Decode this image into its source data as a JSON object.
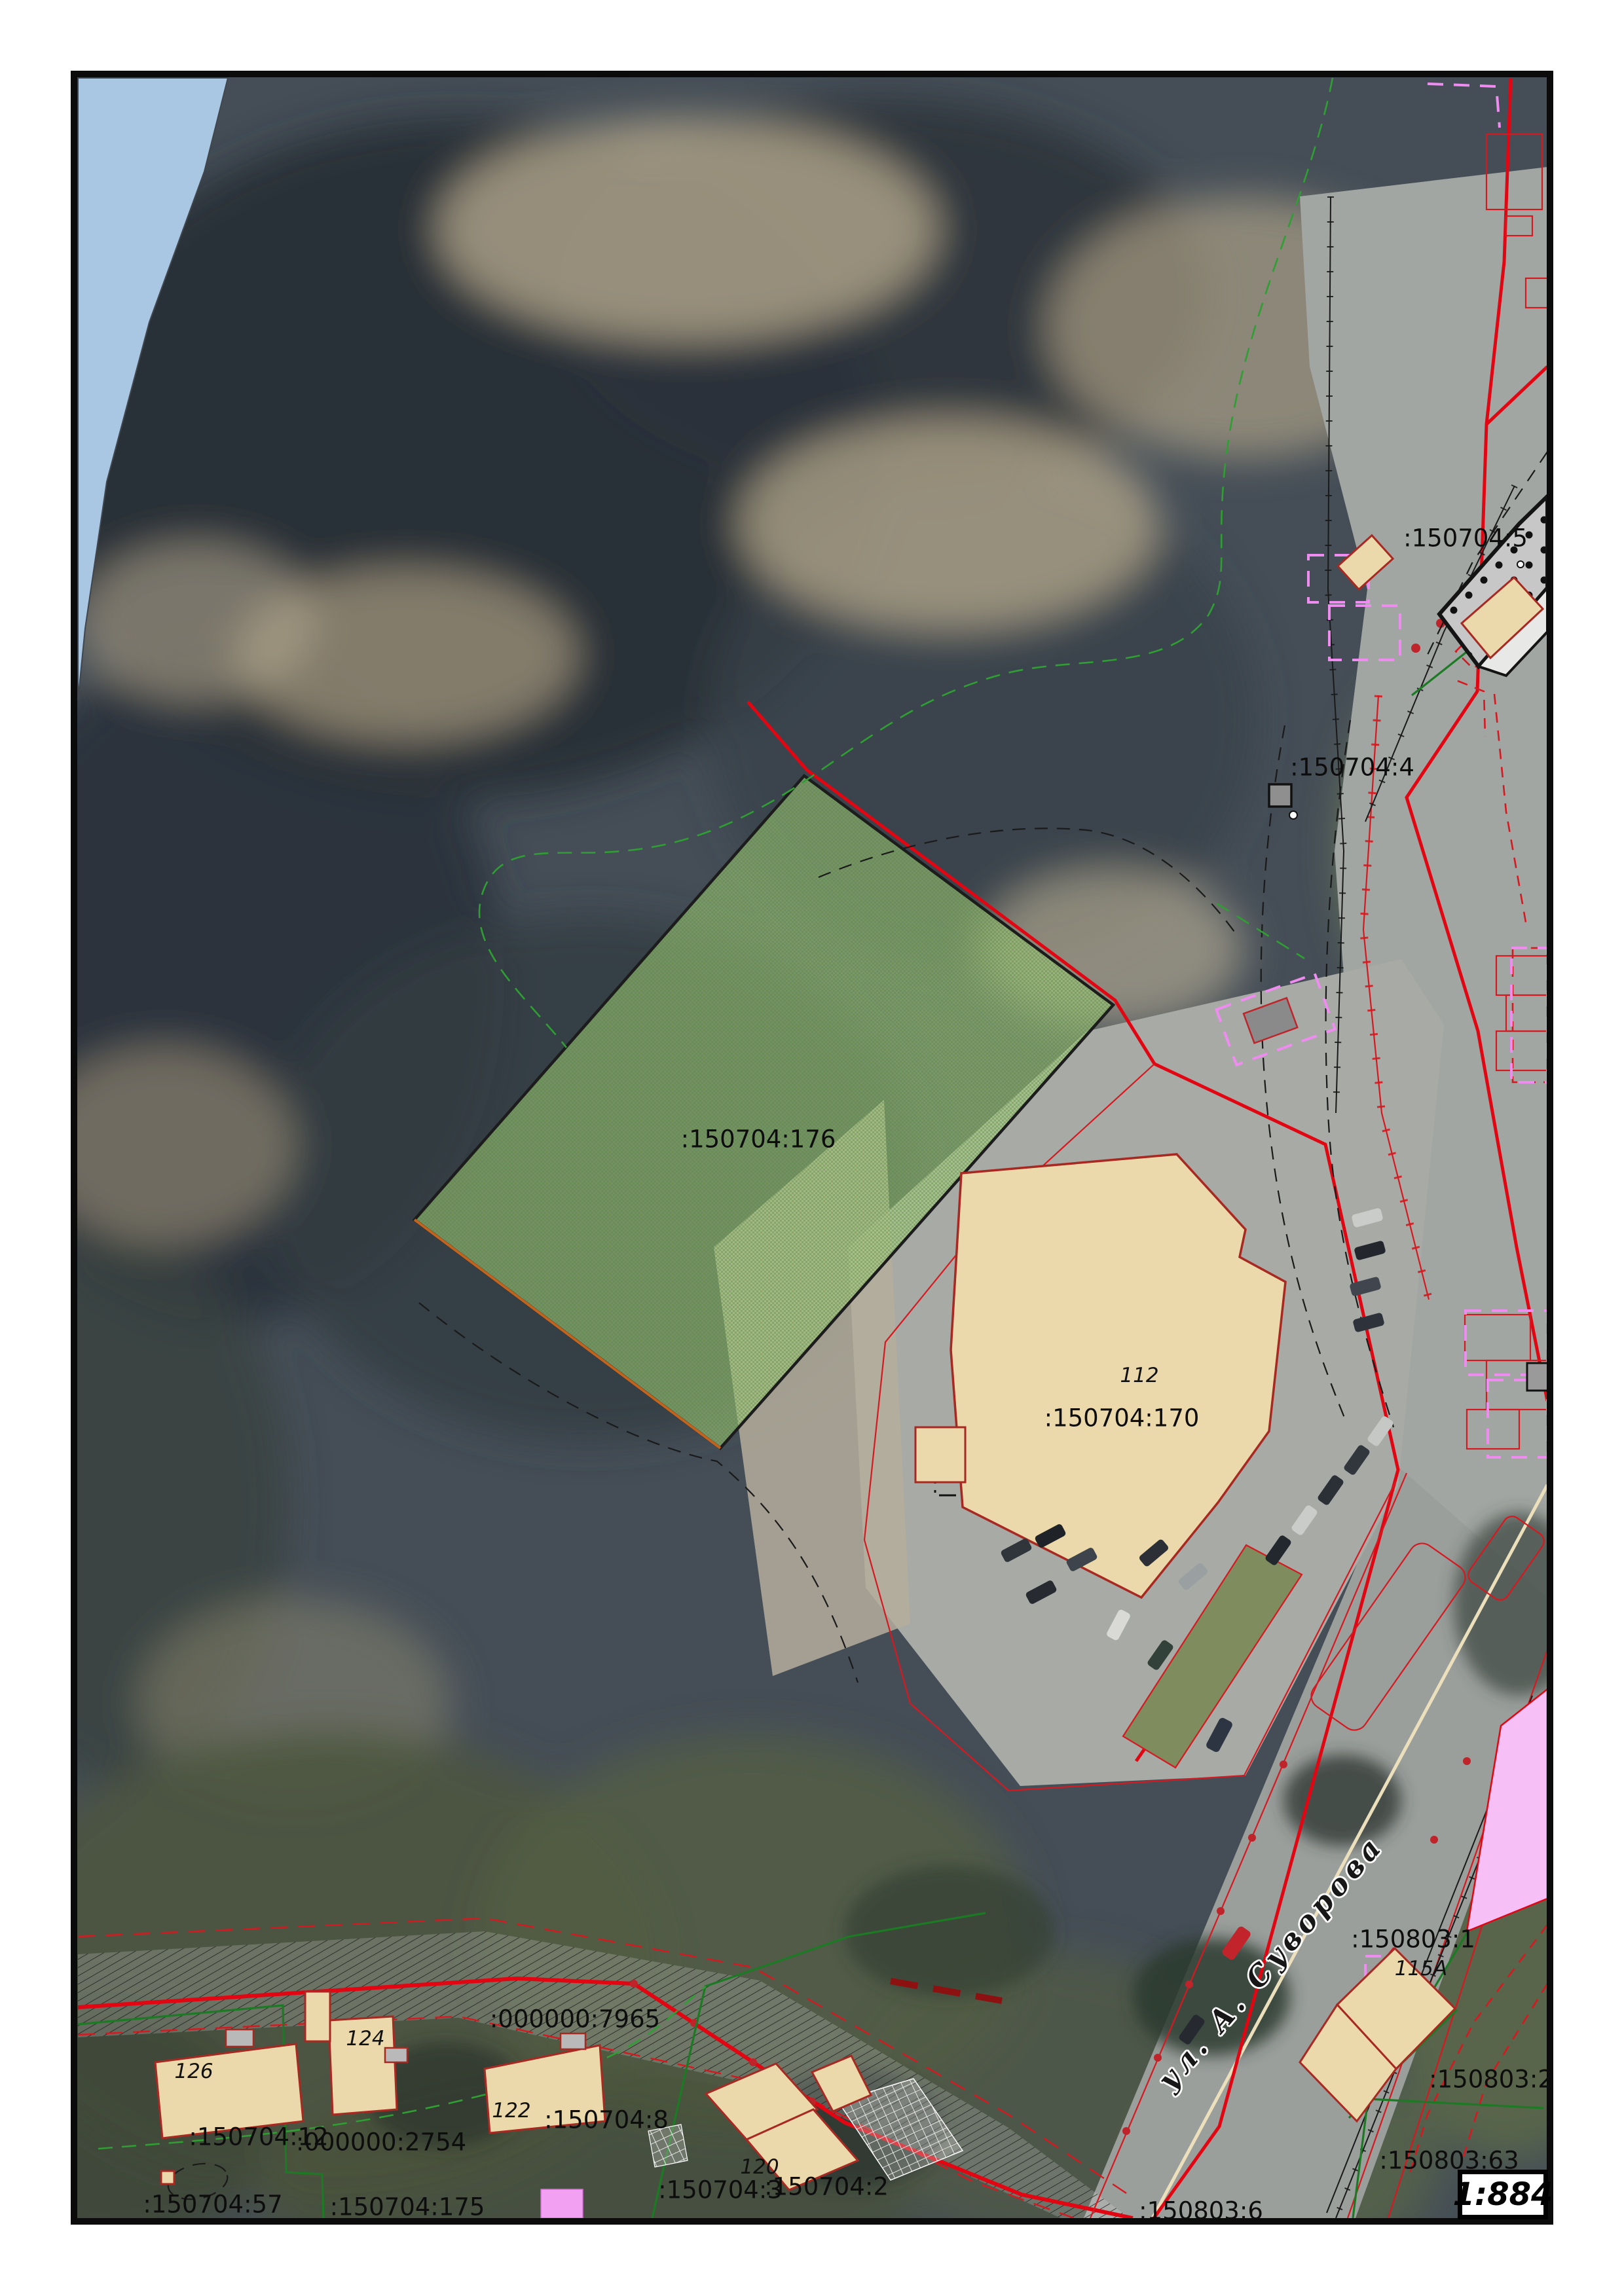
{
  "map": {
    "type": "cadastral-plan-over-orthophoto",
    "scale": {
      "value": "1:884"
    },
    "street": {
      "name": "ул. А. Суворова"
    },
    "labels": {
      "p150704_5": ":150704:5",
      "p150704_4": ":150704:4",
      "p150704_176": ":150704:176",
      "p150704_170": ":150704:170",
      "p150803_1": ":150803:1",
      "p150803_2": ":150803:2",
      "p150803_6": ":150803:6",
      "p150803_63": ":150803:63",
      "p000000_7965": ":000000:7965",
      "p000000_2754": ":000000:2754",
      "p150704_12": ":150704:12",
      "p150704_57": ":150704:57",
      "p150704_175": ":150704:175",
      "p150704_8": ":150704:8",
      "p150704_2": ":150704:2",
      "p150704_3": ":150704:3"
    },
    "house_numbers": {
      "h112": "112",
      "h126": "126",
      "h124": "124",
      "h122": "122",
      "h120": "120",
      "h115a": "115A"
    },
    "colors": {
      "boundary_red": "#e20613",
      "boundary_green": "#1d7a24",
      "boundary_green_dashed": "#2f9e33",
      "boundary_pink_dashed": "#ef8cf0",
      "subject_parcel_fill": "#9ec57c",
      "building_fill": "#ecd9ab",
      "building_stroke": "#a82822",
      "water_fill": "#a9c6e3",
      "frame_black": "#0b0b0b",
      "magenta_parcel_fill": "#f6c0f6",
      "gray_parcel_fill": "#c7c7c7"
    }
  }
}
